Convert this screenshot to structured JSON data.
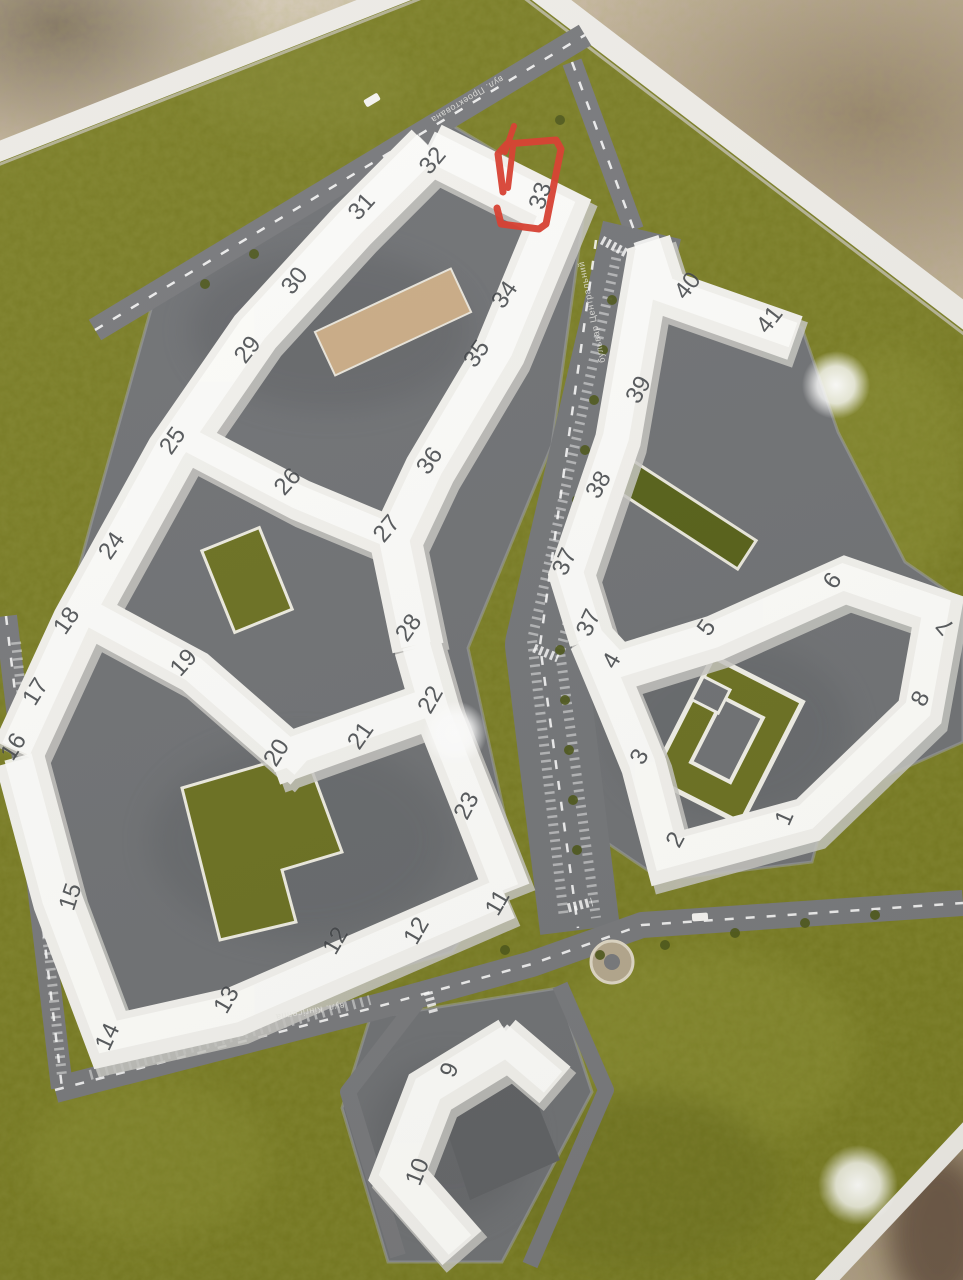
{
  "annotation": {
    "shape": "hand-drawn red loop",
    "marked_building": "33",
    "color": "#d83b2c"
  },
  "buildings": [
    {
      "label": "32",
      "x": 433,
      "y": 161,
      "rot": -50
    },
    {
      "label": "33",
      "x": 541,
      "y": 196,
      "rot": -72
    },
    {
      "label": "31",
      "x": 362,
      "y": 207,
      "rot": -48
    },
    {
      "label": "30",
      "x": 295,
      "y": 281,
      "rot": -52
    },
    {
      "label": "29",
      "x": 248,
      "y": 350,
      "rot": -52
    },
    {
      "label": "25",
      "x": 173,
      "y": 441,
      "rot": -55
    },
    {
      "label": "24",
      "x": 112,
      "y": 546,
      "rot": -55
    },
    {
      "label": "18",
      "x": 67,
      "y": 621,
      "rot": -55
    },
    {
      "label": "17",
      "x": 36,
      "y": 692,
      "rot": -58
    },
    {
      "label": "16",
      "x": 14,
      "y": 747,
      "rot": -58
    },
    {
      "label": "15",
      "x": 71,
      "y": 897,
      "rot": -72
    },
    {
      "label": "14",
      "x": 108,
      "y": 1037,
      "rot": -65
    },
    {
      "label": "13",
      "x": 227,
      "y": 1000,
      "rot": -60
    },
    {
      "label": "12",
      "x": 336,
      "y": 941,
      "rot": -60
    },
    {
      "label": "12",
      "x": 417,
      "y": 931,
      "rot": -60
    },
    {
      "label": "11",
      "x": 498,
      "y": 903,
      "rot": -60
    },
    {
      "label": "23",
      "x": 467,
      "y": 806,
      "rot": -62
    },
    {
      "label": "22",
      "x": 431,
      "y": 700,
      "rot": -60
    },
    {
      "label": "21",
      "x": 361,
      "y": 736,
      "rot": -55
    },
    {
      "label": "20",
      "x": 277,
      "y": 753,
      "rot": -58
    },
    {
      "label": "19",
      "x": 184,
      "y": 663,
      "rot": -48
    },
    {
      "label": "26",
      "x": 288,
      "y": 482,
      "rot": -48
    },
    {
      "label": "27",
      "x": 387,
      "y": 529,
      "rot": -50
    },
    {
      "label": "28",
      "x": 409,
      "y": 628,
      "rot": -55
    },
    {
      "label": "36",
      "x": 430,
      "y": 461,
      "rot": -55
    },
    {
      "label": "35",
      "x": 477,
      "y": 354,
      "rot": -55
    },
    {
      "label": "34",
      "x": 505,
      "y": 295,
      "rot": -55
    },
    {
      "label": "40",
      "x": 688,
      "y": 286,
      "rot": -52
    },
    {
      "label": "41",
      "x": 770,
      "y": 320,
      "rot": -52
    },
    {
      "label": "39",
      "x": 639,
      "y": 390,
      "rot": -60
    },
    {
      "label": "38",
      "x": 599,
      "y": 485,
      "rot": -60
    },
    {
      "label": "37",
      "x": 565,
      "y": 562,
      "rot": -65
    },
    {
      "label": "37",
      "x": 589,
      "y": 623,
      "rot": -65
    },
    {
      "label": "4",
      "x": 612,
      "y": 661,
      "rot": -60
    },
    {
      "label": "5",
      "x": 707,
      "y": 628,
      "rot": -55
    },
    {
      "label": "6",
      "x": 833,
      "y": 581,
      "rot": -55
    },
    {
      "label": "7",
      "x": 946,
      "y": 626,
      "rot": -130
    },
    {
      "label": "8",
      "x": 921,
      "y": 699,
      "rot": -62
    },
    {
      "label": "3",
      "x": 640,
      "y": 757,
      "rot": -62
    },
    {
      "label": "2",
      "x": 676,
      "y": 840,
      "rot": -62
    },
    {
      "label": "1",
      "x": 785,
      "y": 818,
      "rot": -66
    },
    {
      "label": "9",
      "x": 450,
      "y": 1070,
      "rot": -68
    },
    {
      "label": "10",
      "x": 418,
      "y": 1172,
      "rot": -68
    }
  ],
  "streets": [
    {
      "label": "вул. Проектована",
      "x": 467,
      "y": 99,
      "rot": 149
    },
    {
      "label": "бульвар Центральний",
      "x": 592,
      "y": 312,
      "rot": 258
    },
    {
      "label": "вул. Кінгісеппа",
      "x": 310,
      "y": 1011,
      "rot": 170
    }
  ],
  "colors": {
    "grass": "#75781f",
    "road": "#77787b",
    "pad": "#6f7174",
    "building_white": "#f1f0ec",
    "marble": "#c6b5a2",
    "marker_red": "#d83b2c",
    "number_gray": "#3f4246",
    "lawn_green": "#6b7021",
    "tan_roof": "#c9ab85"
  }
}
